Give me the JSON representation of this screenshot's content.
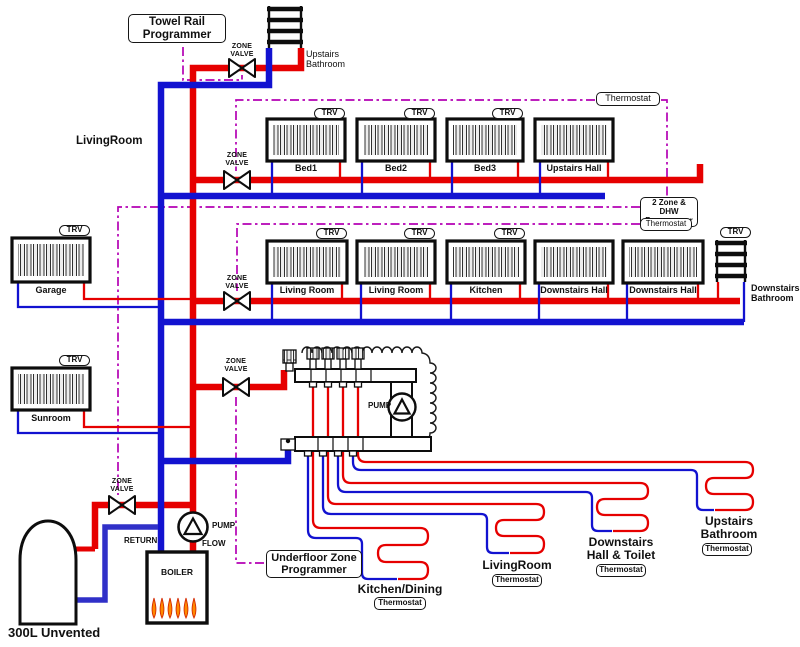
{
  "colors": {
    "flow_pipe": "#e60000",
    "return_pipe": "#1212d0",
    "control_wire": "#b400b4",
    "coil_mid": "#8a1f9e",
    "coil_cold": "#3030c8",
    "flame": "#ff8a00"
  },
  "controls": {
    "towel_rail_programmer": {
      "line1": "Towel Rail",
      "line2": "Programmer"
    },
    "two_zone_programmer": {
      "line1": "2 Zone & DHW",
      "line2": "Programmer"
    },
    "underfloor_programmer": {
      "line1": "Underfloor Zone",
      "line2": "Programmer"
    },
    "thermostat": "Thermostat",
    "trv": "TRV",
    "zone_valve": {
      "line1": "ZONE",
      "line2": "VALVE"
    }
  },
  "equipment": {
    "pump": "PUMP",
    "flow": "FLOW",
    "return": "RETURN",
    "boiler": "BOILER",
    "cylinder": "300L Unvented"
  },
  "areas": {
    "livingroom": "LivingRoom",
    "upstairs_bathroom": {
      "line1": "Upstairs",
      "line2": "Bathroom"
    },
    "downstairs_bathroom": {
      "line1": "Downstairs",
      "line2": "Bathroom"
    }
  },
  "radiators": {
    "bed1": "Bed1",
    "bed2": "Bed2",
    "bed3": "Bed3",
    "upstairs_hall": "Upstairs Hall",
    "living_room_1": "Living Room",
    "living_room_2": "Living Room",
    "kitchen": "Kitchen",
    "downstairs_hall_1": "Downstairs Hall",
    "downstairs_hall_2": "Downstairs Hall",
    "garage": "Garage",
    "sunroom": "Sunroom"
  },
  "underfloor_loops": {
    "kitchen_dining": {
      "line1": "Kitchen/Dining"
    },
    "livingroom": {
      "line1": "LivingRoom"
    },
    "downstairs_hall_toilet": {
      "line1": "Downstairs",
      "line2": "Hall & Toilet"
    },
    "upstairs_bathroom": {
      "line1": "Upstairs",
      "line2": "Bathroom"
    }
  }
}
